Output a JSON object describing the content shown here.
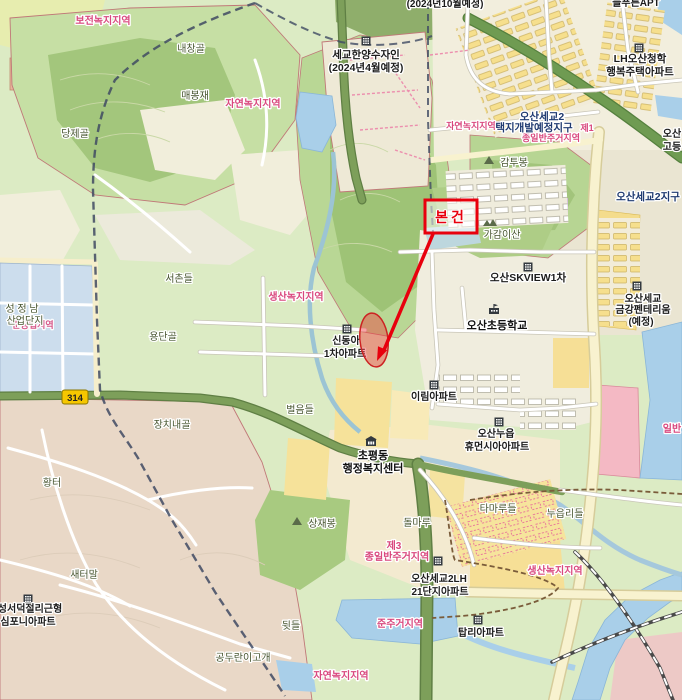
{
  "annotation": {
    "subject_label": "본건"
  },
  "road_badge": {
    "number": "314"
  },
  "labels": {
    "bojeon_green": {
      "text": "보전녹지지역"
    },
    "naechanggol": {
      "text": "내창골"
    },
    "maebongjae": {
      "text": "매봉재"
    },
    "jayeon_green_top": {
      "text": "자연녹지지역"
    },
    "dangjegol": {
      "text": "당제골"
    },
    "segyo_hanyang": {
      "lines": [
        "세교한양수자인",
        "(2024년4월예정)"
      ]
    },
    "top_due": {
      "text": "(2024년10월예정)"
    },
    "top_apt": {
      "text": "늘푸른APT"
    },
    "lh_cheonghak": {
      "lines": [
        "LH오산청학",
        "행복주택아파트"
      ]
    },
    "taekji_district": {
      "lines": [
        "오산세교2",
        "택지개발예정지구"
      ]
    },
    "jayeon_green_mid": {
      "text": "자연녹지지역"
    },
    "je1_zone": {
      "lines": [
        "제1",
        "종일반주거지역"
      ]
    },
    "gamtubong": {
      "text": "감투봉"
    },
    "segyo2_district": {
      "text": "오산세교2지구"
    },
    "osan_high": {
      "lines": [
        "오산",
        "고등"
      ]
    },
    "gagamisan": {
      "text": "가감이산"
    },
    "skview": {
      "text": "오산SKVIEW1차"
    },
    "geumgang": {
      "lines": [
        "오산세교",
        "금강펜테리움",
        "(예정)"
      ]
    },
    "osan_elementary": {
      "text": "오산초등학교"
    },
    "shindonga": {
      "lines": [
        "신동아",
        "1차아파트"
      ]
    },
    "seochondeul": {
      "text": "서촌들"
    },
    "yongdangol": {
      "text": "용단골"
    },
    "saengsan_green_mid": {
      "text": "생산녹지지역"
    },
    "jangchinaegol": {
      "text": "장치내골"
    },
    "seongjeongnam": {
      "lines": [
        "성 정 남",
        "산업단지"
      ]
    },
    "jungongeop": {
      "text": "준공업지역"
    },
    "beoreumdeul": {
      "text": "벌음들"
    },
    "irim": {
      "text": "이림아파트"
    },
    "nueup_humansia": {
      "lines": [
        "오산누읍",
        "휴먼시아아파트"
      ]
    },
    "chopyeong": {
      "lines": [
        "초평동",
        "행정복지센터"
      ]
    },
    "ilban_right": {
      "text": "일반"
    },
    "hwangteo": {
      "text": "황터"
    },
    "sangjaebong": {
      "text": "상재봉"
    },
    "dolmaru": {
      "text": "돌마루"
    },
    "tamarudeul": {
      "text": "타마루들"
    },
    "nueupdeul": {
      "text": "누읍리들"
    },
    "je3_zone": {
      "lines": [
        "제3",
        "종일반주거지역"
      ]
    },
    "segyo2lh": {
      "lines": [
        "오산세교2LH",
        "21단지아파트"
      ]
    },
    "saengsan_green_right": {
      "text": "생산녹지지역"
    },
    "saeteomal": {
      "text": "새터말"
    },
    "symphony": {
      "lines": [
        "성서덕절리근형",
        "심포니아파트"
      ]
    },
    "dwitdeul": {
      "text": "뒷들"
    },
    "junjugeo": {
      "text": "준주거지역"
    },
    "gonduranigogae": {
      "text": "공두란이고개"
    },
    "jayeon_green_bottom": {
      "text": "자연녹지지역"
    },
    "tapri": {
      "text": "탑리아파트"
    }
  },
  "colors": {
    "subject_red": "#e8000d",
    "zone_pink_text": "#d9487e",
    "district_navy_text": "#1f3a70",
    "water_blue": "#a9cfe9",
    "forest_green": "#a5c87e",
    "field_green": "#dcebc4",
    "urban_cream": "#f0ecd9",
    "block_yellow": "#f6df8d",
    "rural_tan": "#e9d8c7",
    "road_olive": "#7d9f5a",
    "commercial_pink": "#f4b9c4",
    "road_badge_yellow": "#f6c700"
  }
}
